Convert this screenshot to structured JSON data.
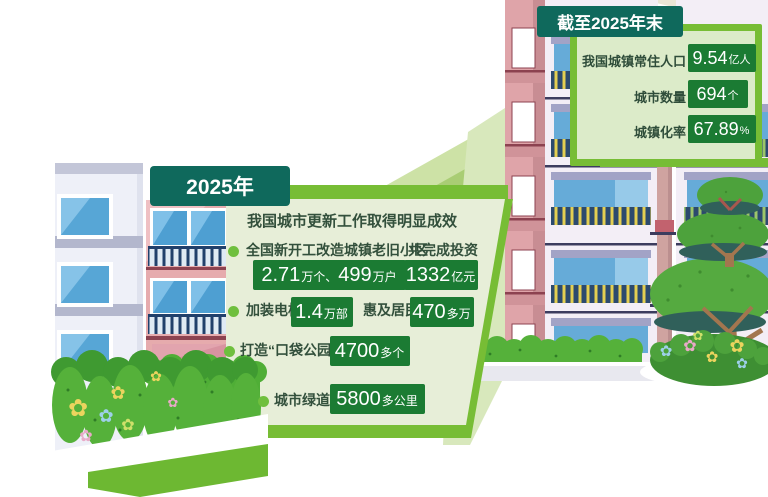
{
  "main_panel": {
    "header": "2025年",
    "title": "我国城市更新工作取得明显成效",
    "row1": {
      "label": "全国新开工改造城镇老旧小区",
      "value_parts": [
        [
          "2.71",
          "num"
        ],
        [
          "万个、",
          "unit"
        ],
        [
          "499",
          "num"
        ],
        [
          "万户",
          "unit"
        ]
      ],
      "label2": "共完成投资",
      "value2_parts": [
        [
          "1332",
          "num"
        ],
        [
          "亿元",
          "unit"
        ]
      ]
    },
    "row2": {
      "label": "加装电梯",
      "value_parts": [
        [
          "1.4",
          "num"
        ],
        [
          "万部",
          "unit"
        ]
      ],
      "label2": "惠及居民",
      "value2_parts": [
        [
          "470",
          "num"
        ],
        [
          "多万",
          "unit"
        ]
      ]
    },
    "row3": {
      "label": "打造“口袋公园”",
      "value_parts": [
        [
          "4700",
          "num"
        ],
        [
          "多个",
          "unit"
        ]
      ]
    },
    "row4": {
      "label": "城市绿道",
      "value_parts": [
        [
          "5800",
          "num"
        ],
        [
          "多公里",
          "unit"
        ]
      ]
    }
  },
  "summary_panel": {
    "header": "截至2025年末",
    "rows": [
      {
        "label": "我国城镇常住人口",
        "value_parts": [
          [
            "9.54",
            "num"
          ],
          [
            "亿人",
            "unit"
          ]
        ]
      },
      {
        "label": "城市数量",
        "value_parts": [
          [
            "694",
            "num"
          ],
          [
            "个",
            "unit"
          ]
        ]
      },
      {
        "label": "城镇化率",
        "value_parts": [
          [
            "67.89",
            "num"
          ],
          [
            "%",
            "unit"
          ]
        ]
      }
    ]
  },
  "icons": {
    "flower_glyph": "✿"
  },
  "colors": {
    "header_teal": "#0f695c",
    "accent_green": "#77bd35",
    "stat_box_green": "#1b7b33",
    "panel_light_green": "#e7eed8",
    "summary_panel_green": "#dcebc9"
  }
}
